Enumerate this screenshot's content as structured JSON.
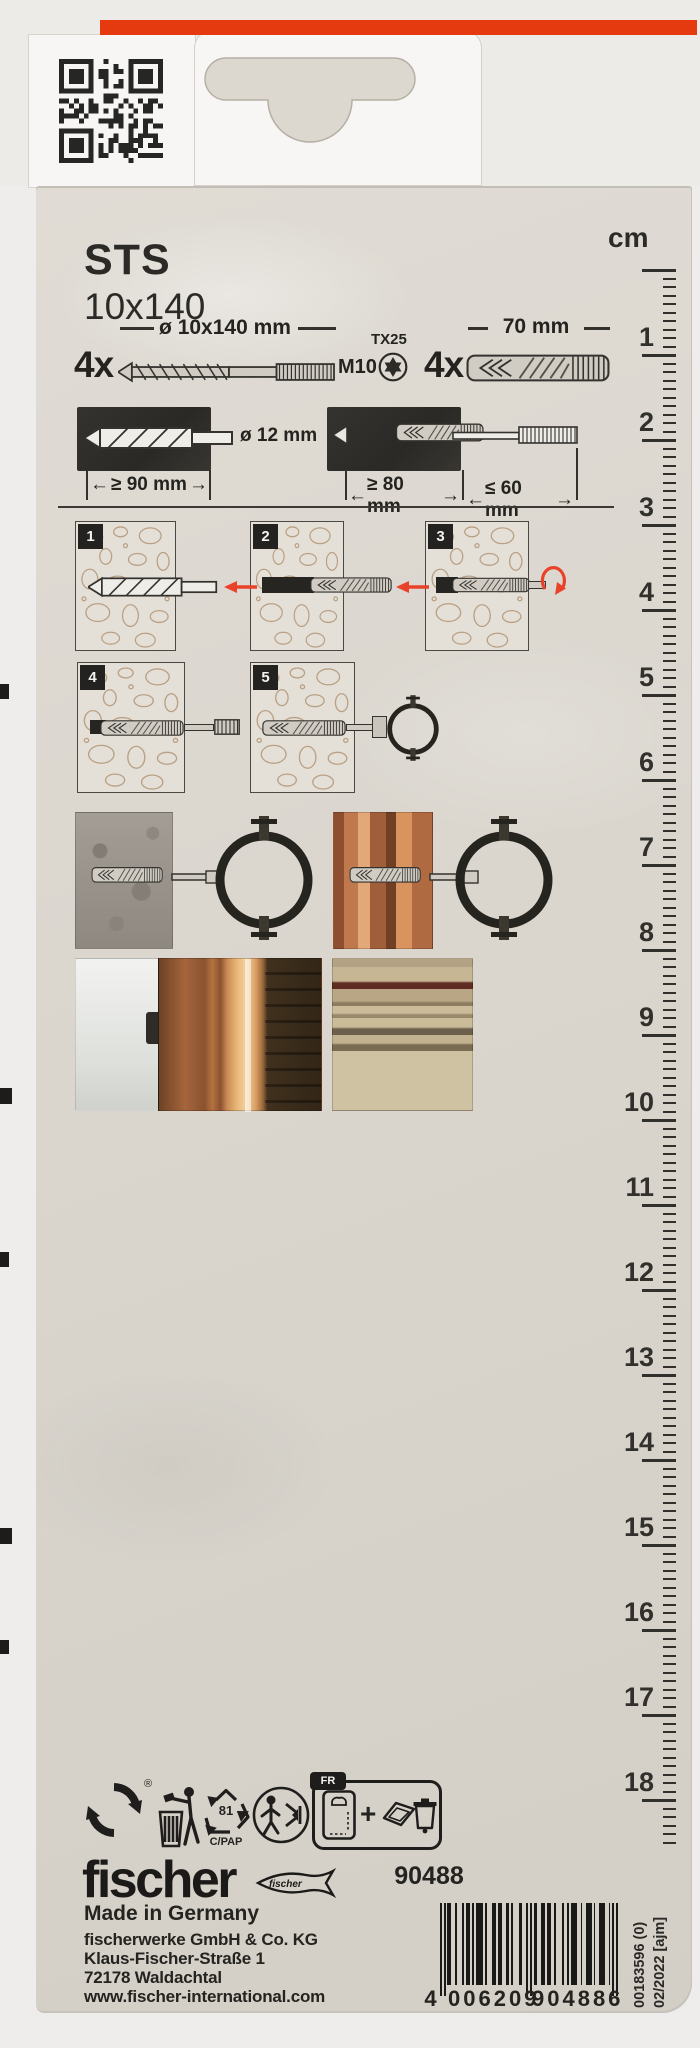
{
  "product": {
    "title": "STS",
    "size": "10x140"
  },
  "ruler": {
    "unit": "cm",
    "numbers": [
      1,
      2,
      3,
      4,
      5,
      6,
      7,
      8,
      9,
      10,
      11,
      12,
      13,
      14,
      15,
      16,
      17,
      18
    ]
  },
  "specs": {
    "screw_qty": "4x",
    "screw_dim": "ø 10x140 mm",
    "screw_thread": "M10",
    "drive": "TX25",
    "plug_qty": "4x",
    "plug_length": "70 mm",
    "drill_diameter": "ø 12 mm",
    "drill_depth": "≥ 90 mm",
    "anchor_depth": "≥ 80 mm",
    "fixture_max": "≤ 60 mm"
  },
  "steps": {
    "labels": [
      "1",
      "2",
      "3",
      "4",
      "5"
    ]
  },
  "recycling": {
    "registered": "®",
    "code": "81",
    "material": "C/PAP",
    "fr": "FR",
    "plus": "+"
  },
  "footer": {
    "brand": "fischer",
    "article_number": "90488",
    "made_in": "Made in Germany",
    "address": [
      "fischerwerke GmbH & Co. KG",
      "Klaus-Fischer-Straße 1",
      "72178 Waldachtal",
      "www.fischer-international.com"
    ],
    "ean_parts": [
      "4",
      "006209",
      "904886"
    ],
    "side_codes": [
      "00183596 (0)",
      "02/2022 [ajm]"
    ]
  },
  "colors": {
    "accent_red": "#e53a10",
    "arrow_red": "#e8432a",
    "card_beige": "#dad6ce",
    "print_black": "#24231f"
  }
}
